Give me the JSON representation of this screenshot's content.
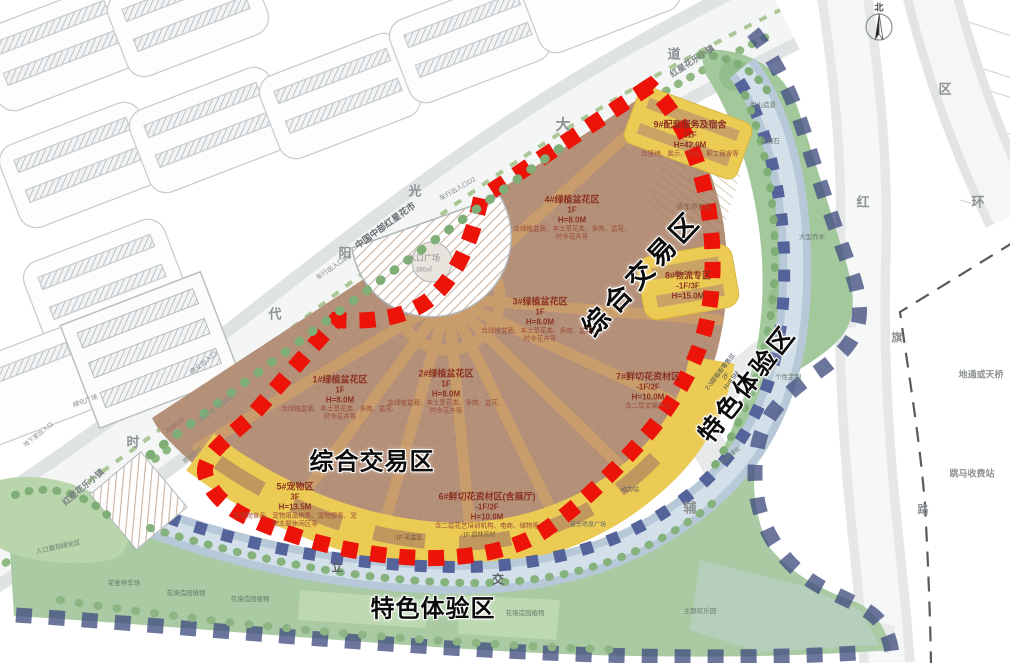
{
  "title": "红星花市项目总平面规划图",
  "zones": {
    "trade": "综合交易区",
    "experience": "特色体验区"
  },
  "blocks": [
    {
      "title": "1#绿植盆花区",
      "floors": "1F",
      "height": "H=8.0M",
      "desc": "含绿植盆栽、本土草花类、多肉、盆花、时令花卉等"
    },
    {
      "title": "2#绿植盆花区",
      "floors": "1F",
      "height": "H=8.0M",
      "desc": "含绿植盆栽、本土草花类、多肉、盆花、时令花卉等"
    },
    {
      "title": "3#绿植盆花区",
      "floors": "1F",
      "height": "H=8.0M",
      "desc": "含绿植盆栽、本土草花类、多肉、盆花、时令花卉等"
    },
    {
      "title": "4#绿植盆花区",
      "floors": "1F",
      "height": "H=8.0M",
      "desc": "含绿植盆栽、本土草花类、多肉、盆花、时令花卉等"
    },
    {
      "title": "5#宠物区",
      "floors": "3F",
      "height": "H=13.5M",
      "desc": "含宠物食品、宠物用品销售、宠物服务、宠物主题休闲区等"
    },
    {
      "title": "6#鲜切花资材区(含展厅)",
      "floors": "-1F/2F",
      "height": "H=10.0M",
      "desc": "含二层花艺培训机构、电商、储物等"
    },
    {
      "title": "7#鲜切花资材区",
      "floors": "-1F/2F",
      "height": "H=10.0M",
      "desc": "含二层文娱中心"
    },
    {
      "title": "8#物流专区",
      "floors": "-1F/3F",
      "height": "H=15.0M",
      "desc": ""
    },
    {
      "title": "9#配套服务及宿舍",
      "floors": "11F",
      "height": "H=42.0M",
      "desc": "含接待、展示、办公、职工宿舍等"
    }
  ],
  "road_chars": [
    "时",
    "代",
    "阳",
    "光",
    "大",
    "道",
    "红",
    "辅",
    "环",
    "区",
    "旗",
    "路",
    "立",
    "交"
  ],
  "labels": {
    "market_banner": "中国中部红星花市",
    "town_top": "红星花乐小镇",
    "town_left": "红星花乐小镇",
    "plaza": "入口广场",
    "plaza_area": "380㎡",
    "green_plaza": "绿化广场",
    "basement_exit": "地下室出入口",
    "biz_entrance": "商业出入口",
    "car_entrance_d1": "车行出入口D1",
    "car_entrance_d2": "车行出入口D2",
    "car_entrance_d3": "车行出入口D3",
    "truck_parking": "货车停车区",
    "rockery": "假山造景",
    "landscape_stone": "景观石",
    "big_trees": "大型乔木",
    "entrance_green": "入口景观绿化区",
    "flower_parking": "花宴停车场",
    "garden_plants_1": "花境造园植物",
    "garden_plants_2": "花境造园植物",
    "garden_plants_3": "花境造园植物",
    "music_fountain": "音乐喷泉广场",
    "pot_zone": "-1F 花盆区",
    "garden_material": "-1F 园林资材",
    "custom_zone": "个性定制",
    "green_belt": "园林绿化",
    "power_station": "动力站",
    "street_retail": "2-3层临街零售区",
    "retail_floors": "2F",
    "retail_height": "H=9.5M",
    "theme_area": "主题欢乐园",
    "underpass": "地通或天桥",
    "toll_station": "跳马收费站",
    "red_line": "用地红线",
    "setback_line": "建筑退线",
    "compass_north": "北"
  },
  "colors": {
    "boundary_red": "#ec1309",
    "boundary_navy": "#47508c",
    "fan_brown": "#b5917a",
    "band_yellow": "#eccb55",
    "band_blue": "#b7c9d8",
    "park_green": "#a9caa2"
  }
}
